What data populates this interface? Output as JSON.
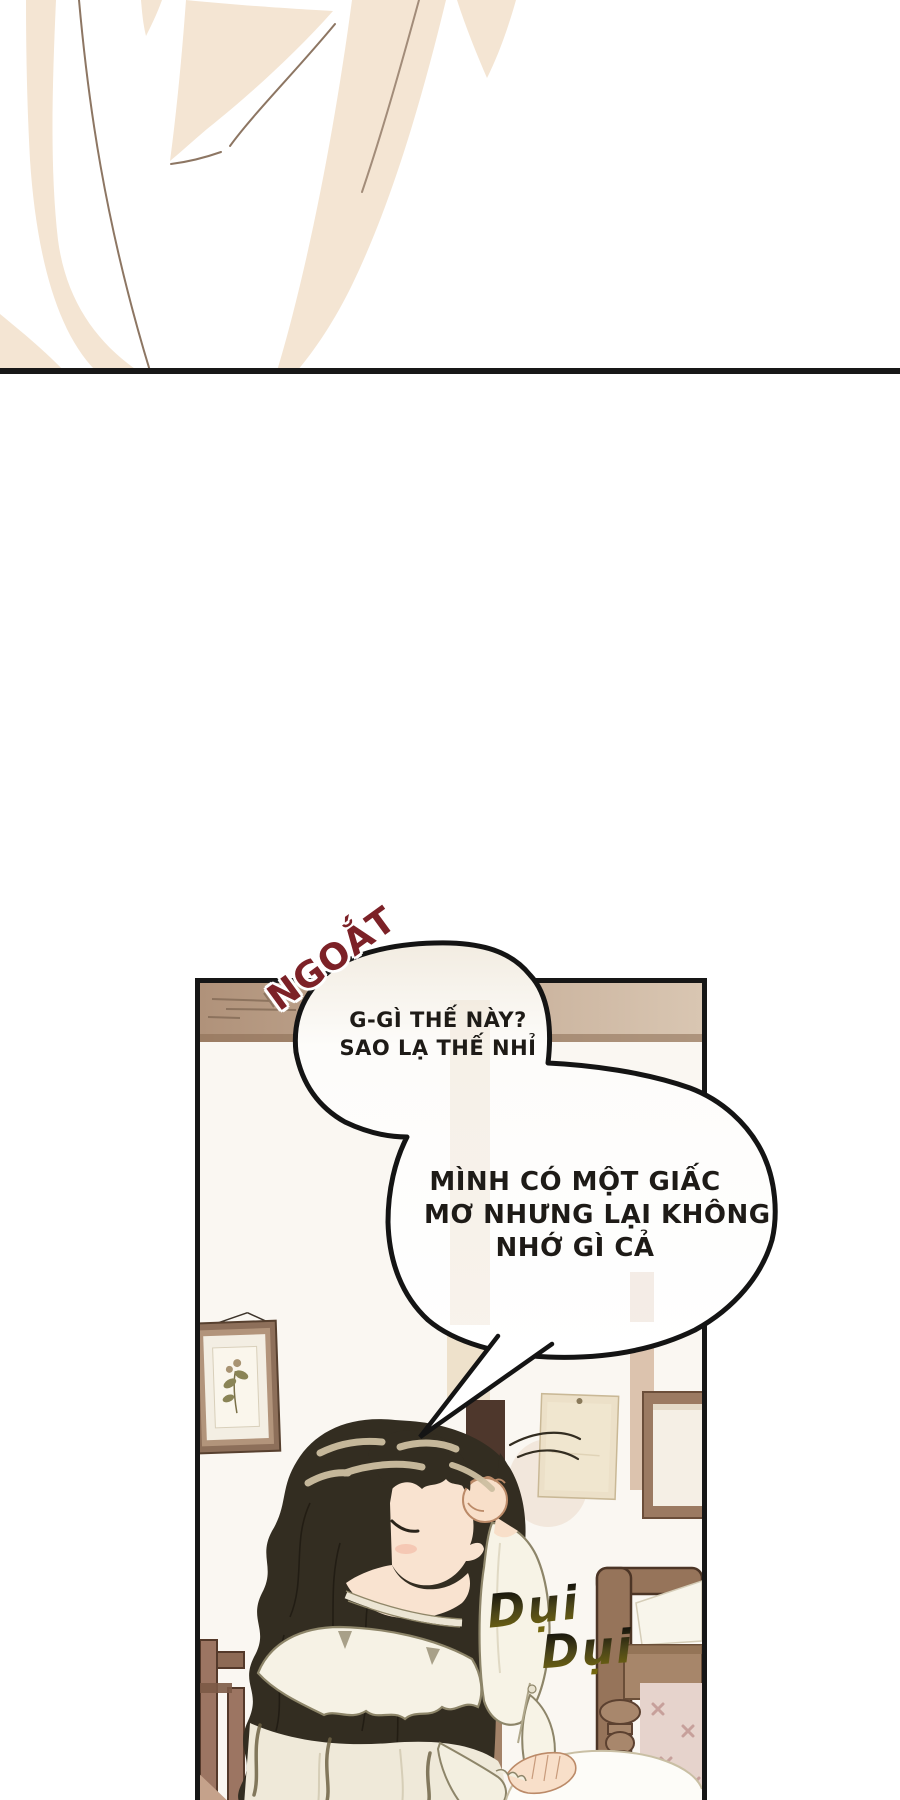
{
  "comic": {
    "sfx": {
      "ngoat": "NGOẮT",
      "dui_first": "Dụi",
      "dui_second": "Dụi"
    },
    "bubble_one": {
      "line1": "G-GÌ THẾ NÀY?",
      "line2": "SAO LẠ THẾ NHỈ"
    },
    "bubble_two": {
      "line1": "MÌNH CÓ MỘT GIẤC",
      "line2": "MƠ NHƯNG LẠI KHÔNG",
      "line3": "NHỚ GÌ CẢ"
    },
    "colors": {
      "sfx_ngoat": "#7c2127",
      "sfx_dui": "#6f6524",
      "bubble_fill": "#fefdfb",
      "bubble_outline": "#141414",
      "panel_border": "#161616",
      "wall_trim": "#b79a81",
      "wood": "#96745a",
      "hair": "#332d21",
      "top_art_cream": "#f4e5d3",
      "divider": "#181818"
    }
  }
}
